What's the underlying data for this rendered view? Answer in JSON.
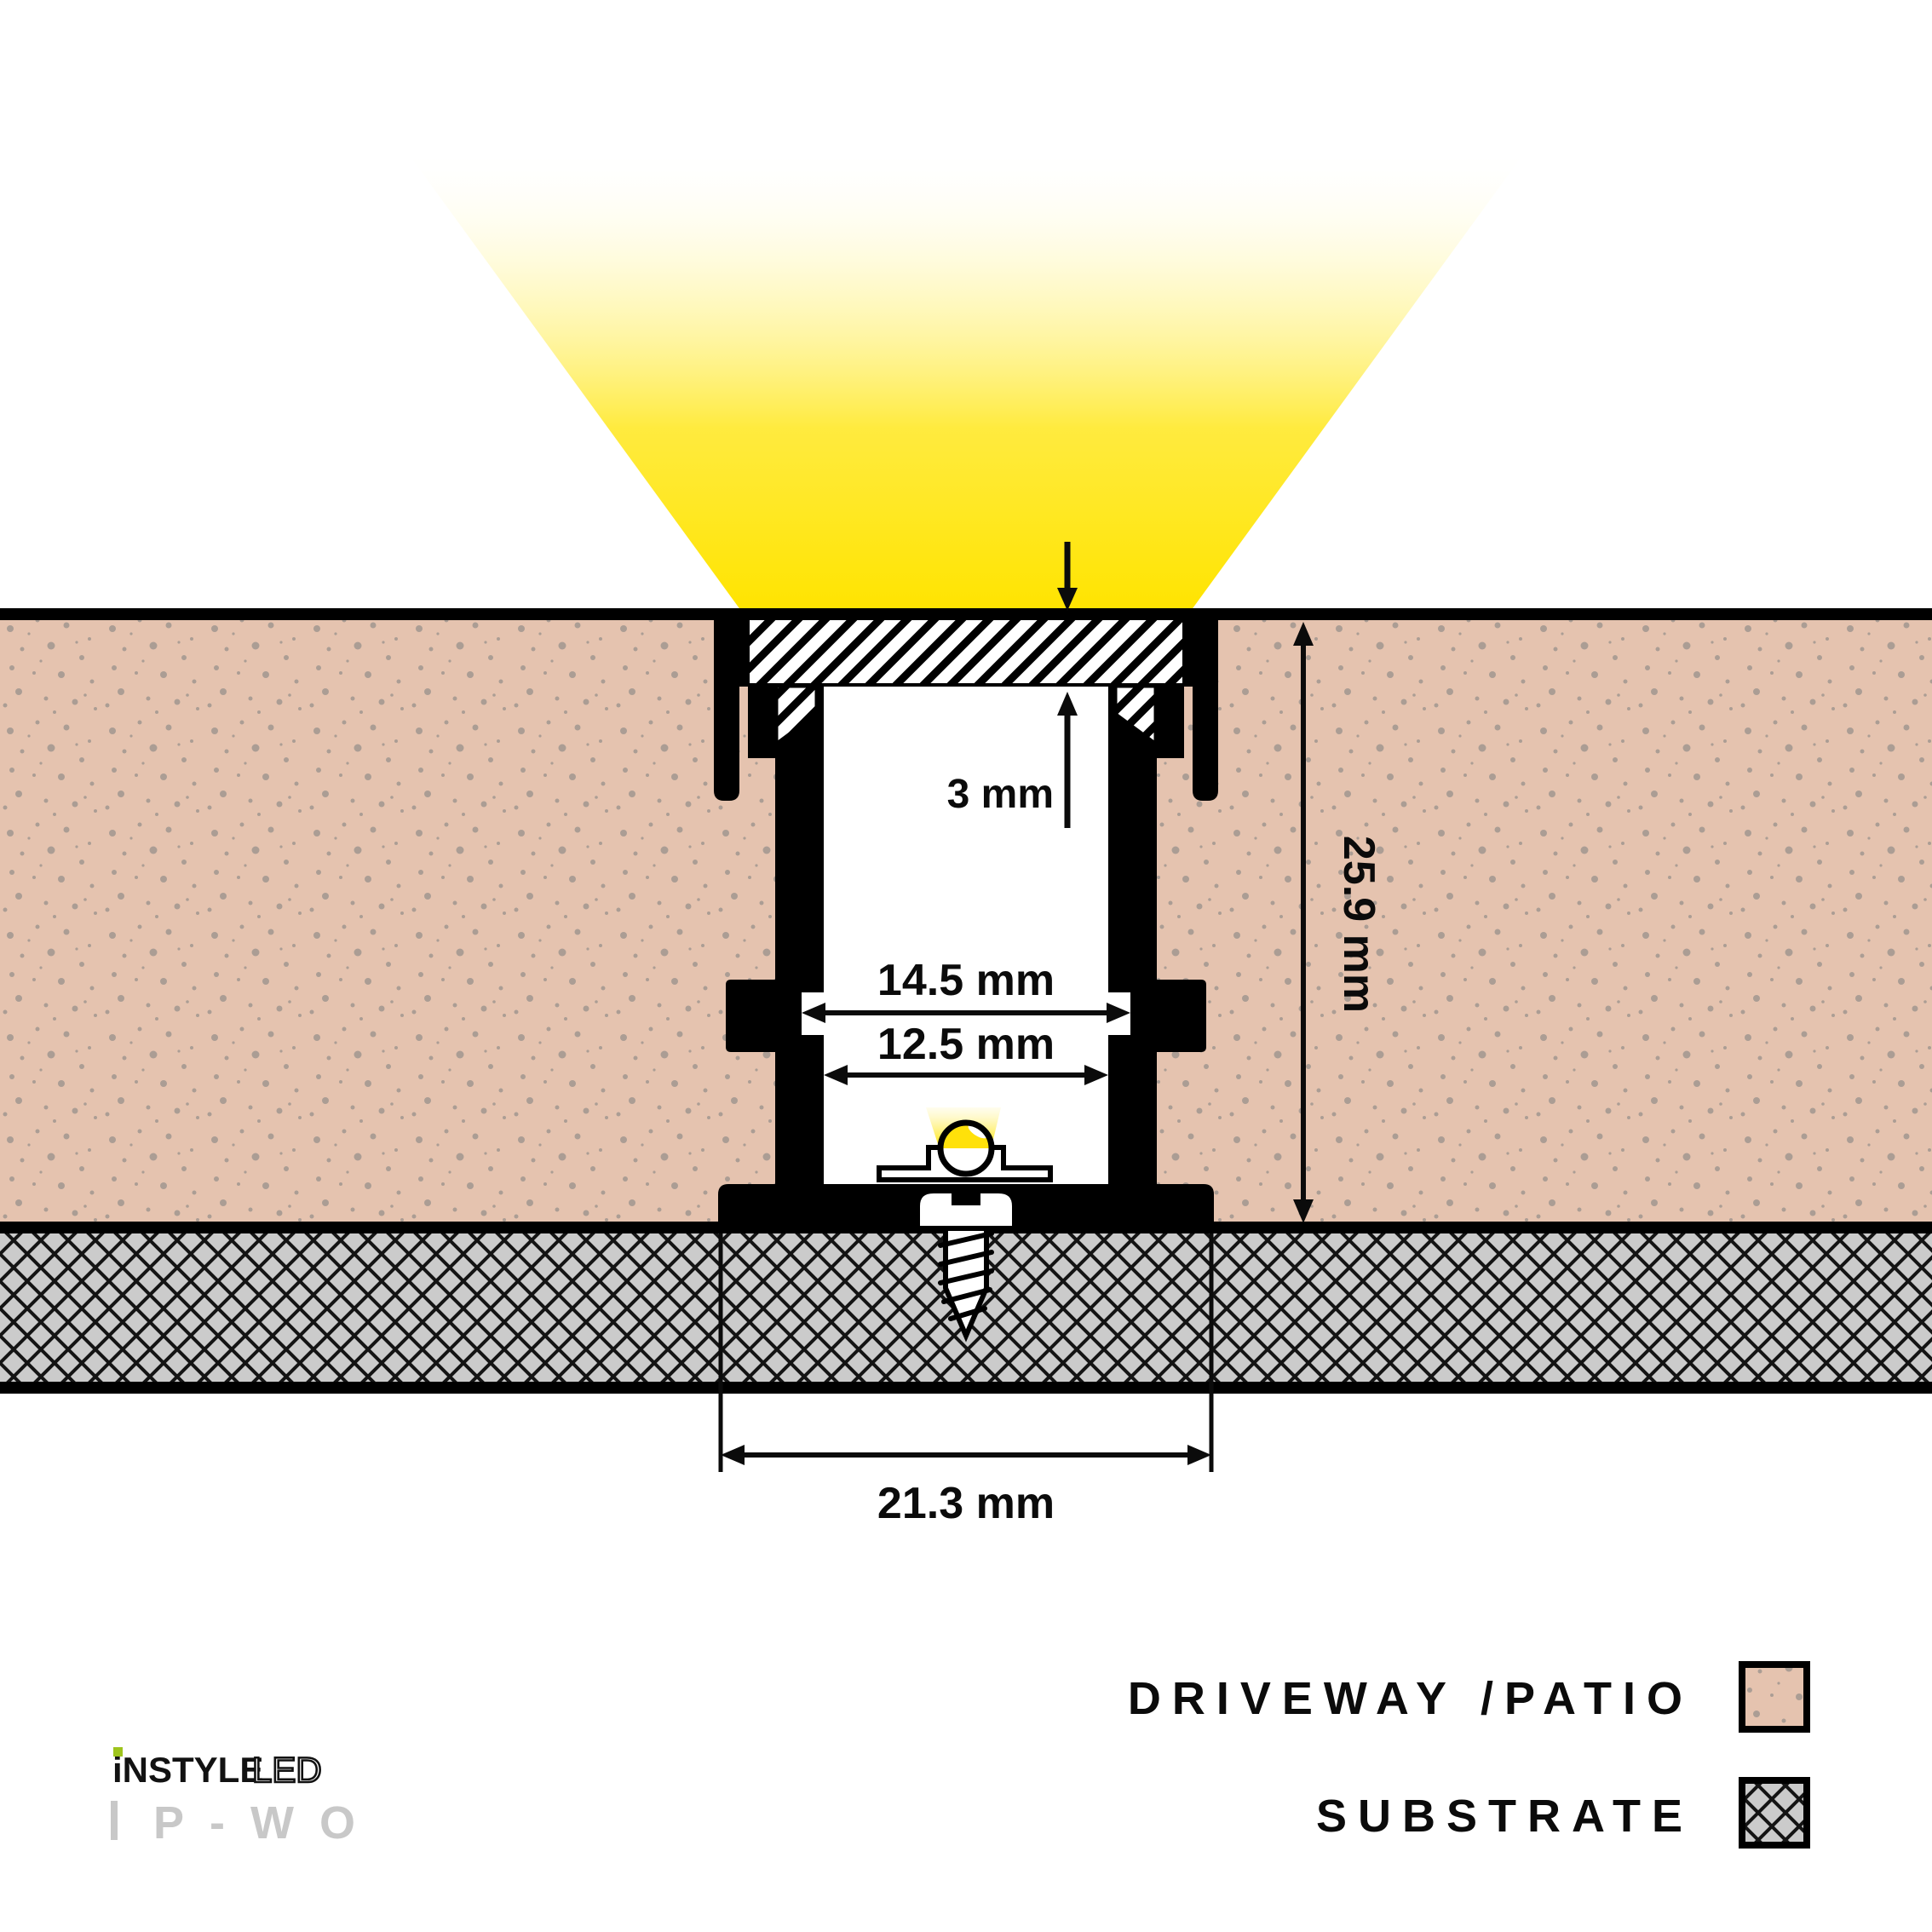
{
  "diagram": {
    "title": "Recessed LED profile driveway installation cross-section",
    "dimensions": {
      "recess_depth": "3 mm",
      "inner_width_upper": "14.5 mm",
      "inner_width_lower": "12.5 mm",
      "overall_height": "25.9 mm",
      "base_width": "21.3 mm"
    },
    "legend": {
      "items": [
        {
          "id": "driveway",
          "label": "DRIVEWAY /PATIO"
        },
        {
          "id": "substrate",
          "label": "SUBSTRATE"
        }
      ]
    },
    "logo": {
      "brand": "iNSTYLE",
      "brand_suffix": "LED",
      "model": "P-WO"
    },
    "colors": {
      "beam_yellow": "#ffe400",
      "led_yellow": "#ffe10a",
      "driveway_fill": "#e5c3af",
      "driveway_speckle": "#a1978f",
      "substrate_fill": "#cbcbcb",
      "profile_black": "#000000",
      "logo_green": "#9ec41d",
      "logo_gray": "#c8c8c8"
    }
  }
}
